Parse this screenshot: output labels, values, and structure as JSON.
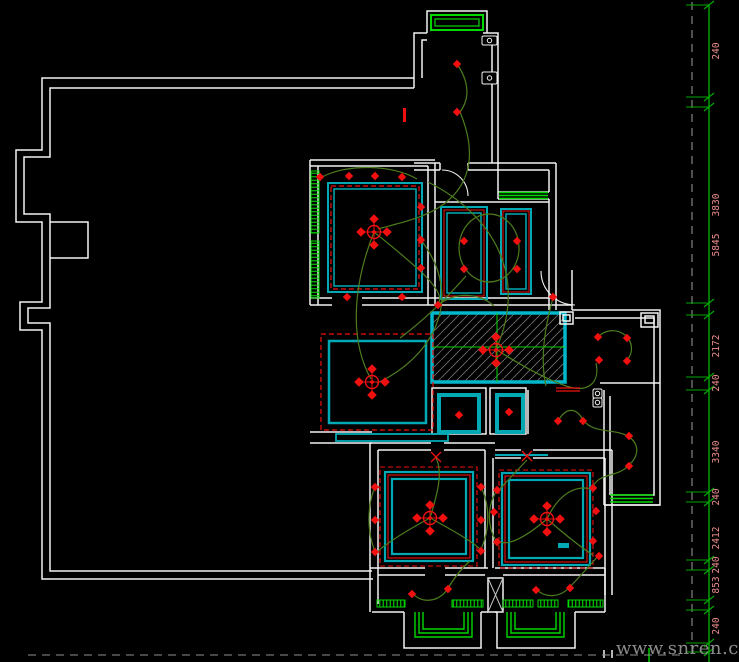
{
  "watermark": {
    "text": "www.snren.com"
  },
  "colors": {
    "bg": "#000000",
    "wall": "#f2f2f2",
    "cyan": "#00a9b4",
    "cyan_bright": "#00b8cc",
    "red": "#f01010",
    "wire": "#4d7d1d",
    "window_green": "#00d800",
    "ruler_green": "#00a800",
    "dim_text": "#ef8d8d",
    "hatch_line": "#6e6e6e",
    "dashed_gray": "#8f8f8f",
    "shaft_x": "#c4c4c4",
    "watermark_gray": "#8c8c8c"
  },
  "ruler": {
    "line": "M709,4 V662",
    "tick_ys": [
      5,
      97,
      107,
      303,
      315,
      377,
      390,
      492,
      502,
      560,
      570,
      600,
      610,
      643,
      652
    ],
    "labels": [
      {
        "text": "240",
        "y": 51
      },
      {
        "text": "3830",
        "y": 205
      },
      {
        "text": "5845",
        "y": 245
      },
      {
        "text": "2172",
        "y": 346
      },
      {
        "text": "240",
        "y": 383
      },
      {
        "text": "3340",
        "y": 452
      },
      {
        "text": "240",
        "y": 497
      },
      {
        "text": "2412",
        "y": 538
      },
      {
        "text": "240",
        "y": 565
      },
      {
        "text": "853",
        "y": 585
      },
      {
        "text": "240",
        "y": 626
      }
    ]
  },
  "hatched_area": {
    "rect": [
      432,
      313,
      133,
      69
    ],
    "cross": [
      497,
      347
    ]
  },
  "layers": [
    {
      "name": "walls",
      "color": "wall",
      "width": 1.5,
      "items": [
        "M414,78 H42 V150 H16 V222 H42 V302 H20 V330 H42 V579 H373",
        "M414,88 H50 V157 H24 V214 H50 V308 H28 V323 H50 V571 H372",
        "M50,222 H88 V258 H50",
        "M414,88 V33 H427",
        "M422,78 V40 H427",
        "M483,33 H498 V170",
        "M483,40 H492 V163",
        "M427,33 V11 H487 V33",
        "M414,163 H440 M468,163 H556",
        "M414,170 H440 M468,170 H549",
        "M440,163 V170 M468,163 V170",
        "M556,163 V310",
        "M549,170 V192",
        "M498,170 V199",
        "M498,192 H549",
        "M498,199 H549",
        "M549,199 V310",
        "M435,202 H549",
        "M310,160 H435",
        "M310,166 H428",
        "M310,160 V305",
        "M318,166 V305",
        "M428,166 V305",
        "M435,163 V305",
        "M310,298 H332 M362,298 H556",
        "M310,305 H332 M362,305 H572",
        "M572,270 V310",
        "M572,310 H660 V505 H604",
        "M575,318 H654 V495 H610",
        "M604,390 V505",
        "M610,396 V495",
        "M600,383 H660",
        "M528,390 V434",
        "M432,388 H486 V434 H432 Z",
        "M490,388 H526 V434 H490 Z",
        "M310,432 H372",
        "M310,443 H372",
        "M370,443 H431 M444,443 H495",
        "M378,450 H431 M444,450 H485",
        "M370,443 V612",
        "M378,450 V604",
        "M485,450 V568",
        "M493,458 V568",
        "M495,450 H521 M533,450 H612",
        "M495,458 H521 M533,458 H605",
        "M612,450 V595",
        "M605,458 V595",
        "M604,505 H660",
        "M370,568 H425 M445,568 H488",
        "M378,575 H425 M445,575 H485",
        "M372,612 H404 M481,612 H488",
        "M404,612 V648 H481 V612",
        "M495,568 H605",
        "M503,575 H605",
        "M495,612 H497 M575,612 H605",
        "M497,612 V648 H575 V612",
        "M488,578 H503 V612 H488 Z",
        "M605,568 V612",
        "M560,312 H573 V324 H560 Z",
        "M563,315 H570 V321 H563 Z",
        "M641,313 H658 V327 H641 Z",
        "M645,316 H654 V323 H645 Z",
        "M604,650 V658 M612,650 V658"
      ]
    },
    {
      "name": "door-arcs",
      "color": "wall",
      "width": 1.1,
      "items": [
        "M442,170 A26,26 0 0 1 468,196",
        "M541,271 A34,34 0 0 0 575,305"
      ]
    },
    {
      "name": "shaft-x",
      "color": "shaft_x",
      "width": 1,
      "items": [
        "M488,578 L503,612 M503,578 L488,612"
      ]
    },
    {
      "name": "windows",
      "color": "window_green",
      "width": 1.4,
      "items": [
        {
          "r": [
            431,
            15,
            52,
            15
          ],
          "sw": 2
        },
        {
          "r": [
            435,
            19,
            44,
            7
          ],
          "sw": 1.2
        },
        "M499,192.5 H548 M499,195.5 H548 M499,198.5 H548",
        "M610,495 H653 M610,498.5 H653 M610,502 H653",
        "M415,612 V637 H472 V612",
        "M419,612 V633 H468 V612",
        "M423,612 V629 H464 V612",
        "M507,612 V637 H564 V612",
        "M511,612 V633 H560 V612",
        "M515,612 V629 H556 V612",
        "M649,648 V662"
      ]
    },
    {
      "name": "window-sills",
      "color": "window_green",
      "width": 1,
      "items": [
        {
          "r": [
            311,
            171,
            8,
            62
          ],
          "sw": 1,
          "pat": "hl"
        },
        {
          "r": [
            311,
            241,
            8,
            57
          ],
          "sw": 1,
          "pat": "hl"
        },
        {
          "r": [
            377,
            600,
            28,
            7
          ],
          "sw": 1,
          "pat": "vl"
        },
        {
          "r": [
            452,
            600,
            31,
            7
          ],
          "sw": 1,
          "pat": "vl"
        },
        {
          "r": [
            503,
            600,
            30,
            7
          ],
          "sw": 1,
          "pat": "vl"
        },
        {
          "r": [
            538,
            600,
            20,
            7
          ],
          "sw": 1,
          "pat": "vl"
        },
        {
          "r": [
            568,
            600,
            35,
            7
          ],
          "sw": 1,
          "pat": "vl"
        }
      ]
    },
    {
      "name": "ceiling-cyan",
      "color": "cyan",
      "width": 2,
      "items": [
        {
          "r": [
            328,
            183,
            94,
            109
          ],
          "sw": 2
        },
        {
          "r": [
            334,
            189,
            82,
            97
          ],
          "sw": 1.5
        },
        {
          "r": [
            441,
            207,
            46,
            92
          ],
          "sw": 2
        },
        {
          "r": [
            447,
            213,
            34,
            80
          ],
          "sw": 1.5
        },
        {
          "r": [
            501,
            209,
            30,
            85
          ],
          "sw": 2
        },
        {
          "r": [
            506,
            214,
            20,
            75
          ],
          "sw": 1.5
        },
        {
          "r": [
            329,
            341,
            97,
            82
          ],
          "sw": 2.5
        },
        {
          "r": [
            385,
            472,
            88,
            89
          ],
          "sw": 2.2
        },
        {
          "r": [
            392,
            479,
            74,
            75
          ],
          "sw": 2.2
        },
        {
          "r": [
            502,
            473,
            88,
            92
          ],
          "sw": 2.2
        },
        {
          "r": [
            509,
            480,
            74,
            78
          ],
          "sw": 2.2
        },
        {
          "r": [
            439,
            395,
            40,
            37
          ],
          "sw": 4
        },
        {
          "r": [
            497,
            395,
            26,
            37
          ],
          "sw": 4
        },
        {
          "r": [
            336,
            434,
            112,
            7
          ],
          "sw": 1.8
        },
        "M495,455 H548",
        {
          "r": [
            558,
            543,
            11,
            5
          ],
          "sw": 0,
          "fill": "cyan"
        }
      ]
    },
    {
      "name": "ceiling-red",
      "color": "red",
      "width": 1.2,
      "items": [
        {
          "r": [
            331,
            186,
            88,
            103
          ],
          "sw": 1.2,
          "dash": "5,3"
        },
        {
          "r": [
            321,
            334,
            112,
            96
          ],
          "sw": 1.2,
          "dash": "5,3"
        },
        {
          "r": [
            444,
            210,
            40,
            86
          ],
          "sw": 1
        },
        {
          "r": [
            503,
            211,
            26,
            81
          ],
          "sw": 1
        },
        {
          "r": [
            380,
            467,
            97,
            99
          ],
          "sw": 1.1,
          "dash": "5,3"
        },
        {
          "r": [
            388,
            475,
            82,
            83
          ],
          "sw": 1.1
        },
        {
          "r": [
            499,
            470,
            94,
            98
          ],
          "sw": 1.1,
          "dash": "5,3"
        },
        {
          "r": [
            505,
            476,
            82,
            86
          ],
          "sw": 1.1
        }
      ]
    },
    {
      "name": "wiring",
      "color": "wire",
      "width": 1.2,
      "items": [
        "M457,64 C468,80 471,97 460,112",
        "M460,112 C478,155 470,188 438,208 C418,220 395,224 378,229",
        "M322,177 C346,164 392,164 417,179",
        "M374,232 C353,285 349,340 371,379",
        "M374,232 C415,265 448,292 438,304",
        "M428,182 C492,214 528,275 497,347",
        "M421,240 C468,302 428,360 377,383",
        "M489,214 a30,34 0 1 0 0.1,0",
        "M466,276 C438,308 416,326 400,338",
        "M497,350 C522,366 546,379 566,386 C590,394 600,381 596,363",
        "M598,337 A16,15 0 1 1 627,360",
        "M553,298 C544,330 540,360 546,386",
        "M558,421 C566,407 576,407 583,420",
        "M583,420 C594,434 612,428 628,436 C641,445 638,457 629,465",
        "M629,465 C616,479 600,471 592,488",
        "M430,518 C404,532 388,542 377,552",
        "M430,518 C438,492 443,472 436,458",
        "M430,518 C456,532 473,542 480,549",
        "M375,487 C367,505 367,533 375,551",
        "M481,487 C490,505 490,530 481,549",
        "M547,519 C521,541 506,546 498,541",
        "M547,519 C569,538 585,550 593,555",
        "M547,519 C559,493 576,485 592,489",
        "M497,490 C487,506 487,526 496,541",
        "M527,460 C509,479 500,489 497,492",
        "M412,593 C422,604 438,602 447,590",
        "M447,590 C455,576 462,568 470,561",
        "M536,589 C546,599 560,597 569,588",
        "M569,588 C582,574 592,563 599,555",
        "M438,305 C455,292 478,292 494,306"
      ]
    },
    {
      "name": "red-marks",
      "color": "red",
      "width": 1.3,
      "items": [
        {
          "r": [
            403,
            108,
            3,
            14
          ],
          "sw": 0,
          "fill": "red"
        },
        "M556,388 H580 M556,391 H580",
        "M431,452 L441,462 M441,452 L431,462",
        "M522,451 L532,461 M532,451 L522,461"
      ]
    },
    {
      "name": "dashed-lines",
      "color": "dashed_gray",
      "width": 1.1,
      "items": [
        {
          "d": "M28,655 H686",
          "dash": "8,6"
        },
        {
          "d": "M692,2 V660",
          "dash": "8,6"
        }
      ]
    }
  ],
  "symbols": {
    "downlights": [
      [
        457,
        64
      ],
      [
        457,
        112
      ],
      [
        320,
        177
      ],
      [
        349,
        176
      ],
      [
        375,
        176
      ],
      [
        402,
        177
      ],
      [
        421,
        207
      ],
      [
        421,
        240
      ],
      [
        421,
        268
      ],
      [
        347,
        297
      ],
      [
        402,
        297
      ],
      [
        464,
        241
      ],
      [
        464,
        269
      ],
      [
        517,
        241
      ],
      [
        517,
        269
      ],
      [
        438,
        305
      ],
      [
        553,
        297
      ],
      [
        598,
        337
      ],
      [
        627,
        338
      ],
      [
        599,
        360
      ],
      [
        627,
        361
      ],
      [
        459,
        415
      ],
      [
        509,
        412
      ],
      [
        558,
        421
      ],
      [
        583,
        421
      ],
      [
        629,
        436
      ],
      [
        629,
        466
      ],
      [
        375,
        487
      ],
      [
        375,
        520
      ],
      [
        375,
        552
      ],
      [
        481,
        487
      ],
      [
        481,
        520
      ],
      [
        481,
        551
      ],
      [
        497,
        490
      ],
      [
        494,
        512
      ],
      [
        497,
        542
      ],
      [
        593,
        488
      ],
      [
        596,
        511
      ],
      [
        593,
        541
      ],
      [
        599,
        556
      ],
      [
        412,
        594
      ],
      [
        448,
        589
      ],
      [
        536,
        590
      ],
      [
        570,
        588
      ]
    ],
    "chandeliers": [
      [
        374,
        232
      ],
      [
        372,
        382
      ],
      [
        496,
        350
      ],
      [
        430,
        518
      ],
      [
        547,
        519
      ]
    ],
    "outlets": [
      {
        "x": 482,
        "y": 36,
        "w": 15,
        "h": 9
      },
      {
        "x": 482,
        "y": 72,
        "w": 15,
        "h": 12
      },
      {
        "x": 593,
        "y": 389,
        "w": 9,
        "h": 9
      },
      {
        "x": 593,
        "y": 398,
        "w": 9,
        "h": 9
      }
    ]
  }
}
